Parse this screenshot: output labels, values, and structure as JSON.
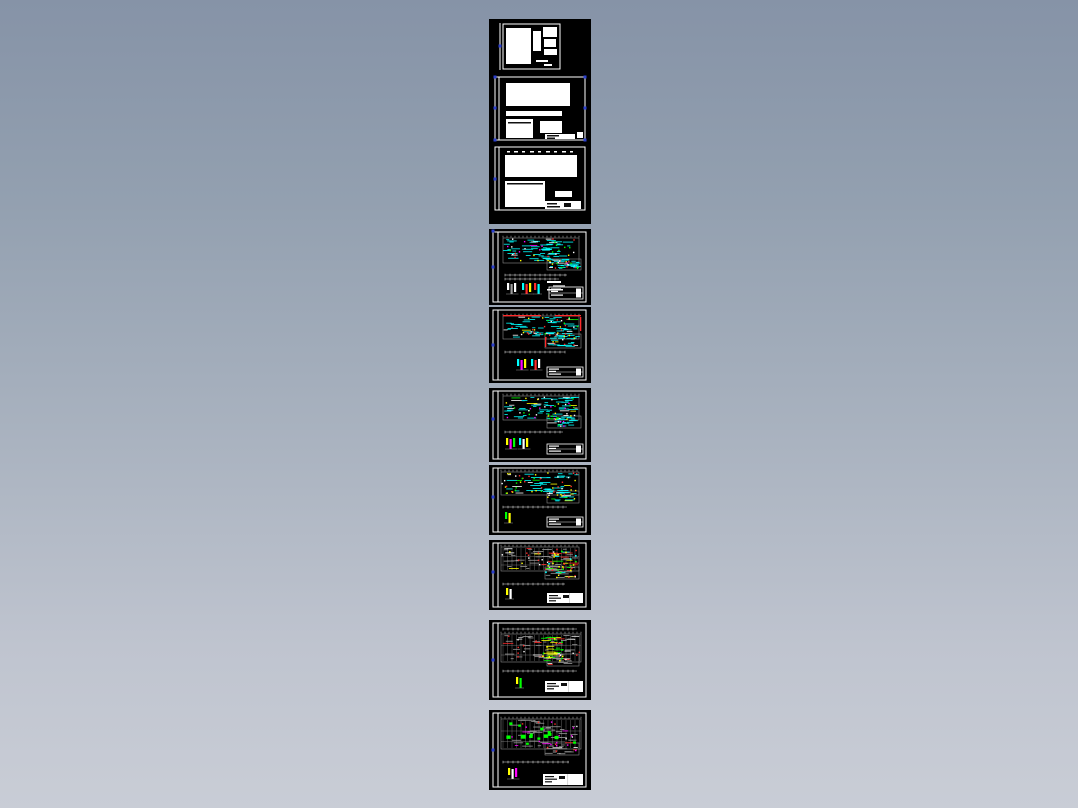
{
  "page": {
    "description": "cad-drawing-preview-strip",
    "sheet_count": 10,
    "background_top": "#8693A7",
    "background_bottom": "#C9CDD6"
  },
  "palette": {
    "black": "#000000",
    "white": "#FFFFFF",
    "gray": "#9A9A9A",
    "lightgray": "#C8C8C8",
    "cyan": "#00FFFF",
    "green": "#00FF00",
    "yellow": "#FFFF00",
    "red": "#FF2A2A",
    "magenta": "#FF00FF",
    "grip_blue": "#2B3FD0",
    "ink": "#101010"
  },
  "strip": {
    "left": 489,
    "width": 102,
    "tiles": [
      {
        "top": 19,
        "height": 205,
        "sheets": [
          {
            "name": "document-sheet-1",
            "kind": "document",
            "leftbar": [
              11,
              4,
              51
            ],
            "frame": [
              14,
              5,
              57,
              45
            ],
            "blocks": [
              [
                17,
                9,
                25,
                36
              ],
              [
                44,
                12,
                8,
                20
              ],
              [
                54,
                8,
                14,
                10
              ],
              [
                55,
                20,
                12,
                8
              ],
              [
                55,
                30,
                13,
                6
              ],
              [
                47,
                41,
                12,
                2
              ],
              [
                55,
                45,
                8,
                2
              ]
            ],
            "marks": [],
            "grips": [
              [
                11,
                27
              ]
            ]
          },
          {
            "name": "document-sheet-2",
            "kind": "document",
            "leftbar": [
              10,
              58,
              121
            ],
            "frame": [
              6,
              58,
              90,
              63
            ],
            "blocks": [
              [
                17,
                64,
                64,
                23
              ],
              [
                17,
                92,
                56,
                5
              ],
              [
                17,
                100,
                27,
                19
              ],
              [
                51,
                102,
                22,
                12
              ],
              [
                56,
                115,
                30,
                5
              ],
              [
                88,
                113,
                6,
                6
              ]
            ],
            "marks": [
              [
                19,
                103,
                23,
                1.5,
                "ink"
              ],
              [
                58,
                116,
                12,
                1.5,
                "ink"
              ],
              [
                58,
                118.5,
                8,
                1.5,
                "ink"
              ]
            ],
            "grips": [
              [
                6,
                58
              ],
              [
                96,
                58
              ],
              [
                6,
                89
              ],
              [
                96,
                89
              ],
              [
                6,
                121
              ],
              [
                96,
                121
              ]
            ]
          },
          {
            "name": "document-sheet-3",
            "kind": "document",
            "leftbar": [
              10,
              128,
              191
            ],
            "frame": [
              6,
              128,
              90,
              63
            ],
            "blocks": [
              [
                16,
                136,
                72,
                22
              ],
              [
                16,
                162,
                40,
                26
              ],
              [
                66,
                172,
                17,
                6
              ],
              [
                56,
                182,
                36,
                8
              ]
            ],
            "marks": [
              [
                18,
                132,
                3,
                1.5,
                "white"
              ],
              [
                25,
                132,
                4,
                1.5,
                "white"
              ],
              [
                33,
                132,
                3,
                1.5,
                "white"
              ],
              [
                41,
                132,
                4,
                1.5,
                "white"
              ],
              [
                49,
                132,
                3,
                1.5,
                "white"
              ],
              [
                57,
                132,
                4,
                1.5,
                "white"
              ],
              [
                65,
                132,
                3,
                1.5,
                "white"
              ],
              [
                73,
                132,
                4,
                1.5,
                "white"
              ],
              [
                81,
                132,
                3,
                1.5,
                "white"
              ],
              [
                18,
                164,
                36,
                1.5,
                "ink"
              ],
              [
                58,
                184,
                10,
                1.5,
                "ink"
              ],
              [
                58,
                187,
                13,
                1.5,
                "ink"
              ],
              [
                75,
                184,
                7,
                4,
                "ink"
              ]
            ],
            "grips": [
              [
                6,
                160
              ]
            ]
          }
        ]
      },
      {
        "top": 229,
        "height": 76,
        "sheets": [
          {
            "name": "floor-plan-sheet-1",
            "kind": "plan",
            "seed": 11,
            "frame": [
              4,
              3,
              93,
              70
            ],
            "leftbar": [
              9,
              3,
              73
            ],
            "band": [
              14,
              9,
              76,
              25
            ],
            "ext": [
              58,
              30,
              34,
              11
            ],
            "grid": false,
            "primary": "cyan",
            "density": 85,
            "dots": 45,
            "accents": [
              "yellow",
              "red",
              "white",
              "green",
              "magenta"
            ],
            "dims": [
              [
                16,
                46,
                78
              ],
              [
                16,
                50,
                70
              ]
            ],
            "details": [
              {
                "x": 18,
                "y": 54,
                "colors": [
                  "white",
                  "gray",
                  "white"
                ]
              },
              {
                "x": 33,
                "y": 54,
                "colors": [
                  "cyan",
                  "red",
                  "yellow"
                ]
              },
              {
                "x": 45,
                "y": 54,
                "colors": [
                  "red",
                  "cyan"
                ]
              }
            ],
            "marks": [
              [
                58,
                52,
                14,
                2,
                "white"
              ],
              [
                64,
                56,
                12,
                2,
                "gray"
              ],
              [
                58,
                60,
                16,
                1.5,
                "white"
              ]
            ],
            "title": {
              "x": 60,
              "y": 58,
              "w": 34,
              "h": 12,
              "style": "outline"
            },
            "grips": [
              [
                4,
                2
              ],
              [
                4,
                38
              ]
            ]
          }
        ]
      },
      {
        "top": 307,
        "height": 76,
        "sheets": [
          {
            "name": "floor-plan-sheet-2",
            "kind": "plan",
            "seed": 22,
            "frame": [
              4,
              3,
              93,
              70
            ],
            "leftbar": [
              9,
              3,
              73
            ],
            "band": [
              14,
              9,
              76,
              23
            ],
            "ext": [
              56,
              27,
              36,
              14
            ],
            "grid": false,
            "primary": "cyan",
            "density": 75,
            "dots": 40,
            "accents": [
              "red",
              "yellow",
              "white",
              "green"
            ],
            "dims": [
              [
                16,
                45,
                76
              ]
            ],
            "details": [
              {
                "x": 28,
                "y": 52,
                "colors": [
                  "cyan",
                  "magenta",
                  "yellow"
                ]
              },
              {
                "x": 42,
                "y": 52,
                "colors": [
                  "cyan",
                  "red",
                  "white"
                ]
              }
            ],
            "marks": [
              [
                14,
                8,
                38,
                1.3,
                "red"
              ],
              [
                66,
                8,
                26,
                1.3,
                "red"
              ],
              [
                91,
                10,
                1.3,
                14,
                "red"
              ],
              [
                56,
                30,
                1.3,
                10,
                "red"
              ]
            ],
            "title": {
              "x": 58,
              "y": 60,
              "w": 36,
              "h": 10,
              "style": "outline"
            },
            "grips": [
              [
                4,
                38
              ]
            ]
          }
        ]
      },
      {
        "top": 388,
        "height": 74,
        "sheets": [
          {
            "name": "floor-plan-sheet-3",
            "kind": "plan",
            "seed": 33,
            "frame": [
              4,
              3,
              93,
              68
            ],
            "leftbar": [
              9,
              3,
              71
            ],
            "band": [
              14,
              8,
              76,
              24
            ],
            "ext": [
              58,
              28,
              34,
              12
            ],
            "grid": false,
            "primary": "cyan",
            "density": 70,
            "dots": 45,
            "accents": [
              "white",
              "yellow",
              "green",
              "magenta"
            ],
            "dims": [
              [
                16,
                44,
                74
              ]
            ],
            "details": [
              {
                "x": 17,
                "y": 50,
                "colors": [
                  "yellow",
                  "magenta",
                  "green"
                ]
              },
              {
                "x": 30,
                "y": 50,
                "colors": [
                  "cyan",
                  "white",
                  "yellow"
                ]
              }
            ],
            "marks": [],
            "title": {
              "x": 58,
              "y": 56,
              "w": 36,
              "h": 10,
              "style": "outline"
            },
            "grips": [
              [
                4,
                31
              ]
            ]
          }
        ]
      },
      {
        "top": 465,
        "height": 70,
        "sheets": [
          {
            "name": "floor-plan-sheet-4",
            "kind": "plan",
            "seed": 44,
            "frame": [
              4,
              3,
              93,
              64
            ],
            "leftbar": [
              9,
              3,
              67
            ],
            "band": [
              12,
              7,
              78,
              23
            ],
            "ext": [
              58,
              26,
              32,
              12
            ],
            "grid": false,
            "primary": "cyan",
            "density": 60,
            "dots": 50,
            "accents": [
              "yellow",
              "yellow",
              "green",
              "red",
              "white"
            ],
            "dims": [
              [
                14,
                42,
                78
              ]
            ],
            "details": [
              {
                "x": 16,
                "y": 47,
                "colors": [
                  "green",
                  "yellow"
                ]
              }
            ],
            "marks": [],
            "title": {
              "x": 58,
              "y": 52,
              "w": 36,
              "h": 10,
              "style": "outline"
            },
            "grips": [
              [
                4,
                32
              ]
            ]
          }
        ]
      },
      {
        "top": 540,
        "height": 70,
        "sheets": [
          {
            "name": "floor-plan-sheet-5",
            "kind": "plan",
            "seed": 55,
            "frame": [
              4,
              3,
              93,
              64
            ],
            "leftbar": [
              9,
              3,
              67
            ],
            "band": [
              12,
              7,
              78,
              24
            ],
            "ext": [
              56,
              27,
              34,
              12
            ],
            "grid": true,
            "primary": "gray",
            "density": 55,
            "dots": 25,
            "accents": [
              "red",
              "yellow",
              "white"
            ],
            "cluster": {
              "x": 56,
              "y": 10,
              "w": 34,
              "h": 24,
              "colors": [
                "cyan",
                "yellow",
                "green",
                "red"
              ]
            },
            "dims": [
              [
                14,
                44,
                76
              ]
            ],
            "details": [
              {
                "x": 17,
                "y": 48,
                "colors": [
                  "yellow",
                  "white"
                ]
              }
            ],
            "marks": [],
            "title": {
              "x": 58,
              "y": 53,
              "w": 36,
              "h": 10,
              "style": "solid"
            },
            "grips": [
              [
                4,
                32
              ]
            ]
          }
        ]
      },
      {
        "top": 620,
        "height": 80,
        "sheets": [
          {
            "name": "floor-plan-sheet-6",
            "kind": "plan",
            "seed": 66,
            "frame": [
              4,
              3,
              93,
              74
            ],
            "leftbar": [
              9,
              3,
              77
            ],
            "topdim": [
              14,
              9,
              88
            ],
            "band": [
              12,
              14,
              80,
              28
            ],
            "ext": [
              58,
              34,
              32,
              12
            ],
            "grid": true,
            "primary": "gray",
            "density": 60,
            "dots": 15,
            "accents": [
              "white",
              "red"
            ],
            "cluster": {
              "x": 52,
              "y": 16,
              "w": 24,
              "h": 26,
              "colors": [
                "green",
                "yellow"
              ]
            },
            "dims": [
              [
                14,
                51,
                88
              ]
            ],
            "details": [
              {
                "x": 27,
                "y": 57,
                "colors": [
                  "yellow",
                  "green"
                ]
              }
            ],
            "marks": [],
            "title": {
              "x": 56,
              "y": 61,
              "w": 38,
              "h": 11,
              "style": "solid"
            },
            "grips": [
              [
                4,
                40
              ]
            ]
          }
        ]
      },
      {
        "top": 710,
        "height": 80,
        "sheets": [
          {
            "name": "floor-plan-sheet-7",
            "kind": "plan",
            "seed": 77,
            "frame": [
              4,
              3,
              93,
              74
            ],
            "leftbar": [
              9,
              3,
              77
            ],
            "band": [
              12,
              9,
              80,
              30
            ],
            "ext": [
              56,
              33,
              34,
              12
            ],
            "grid": true,
            "primary": "gray",
            "density": 55,
            "dots": 22,
            "accents": [
              "red",
              "white",
              "magenta",
              "magenta"
            ],
            "blobs": {
              "color": "green",
              "count": 14
            },
            "dims": [
              [
                14,
                52,
                80
              ]
            ],
            "details": [
              {
                "x": 19,
                "y": 58,
                "colors": [
                  "yellow",
                  "white",
                  "magenta"
                ]
              }
            ],
            "marks": [],
            "title": {
              "x": 54,
              "y": 64,
              "w": 40,
              "h": 11,
              "style": "solid"
            },
            "grips": [
              [
                4,
                40
              ]
            ]
          }
        ]
      }
    ]
  }
}
